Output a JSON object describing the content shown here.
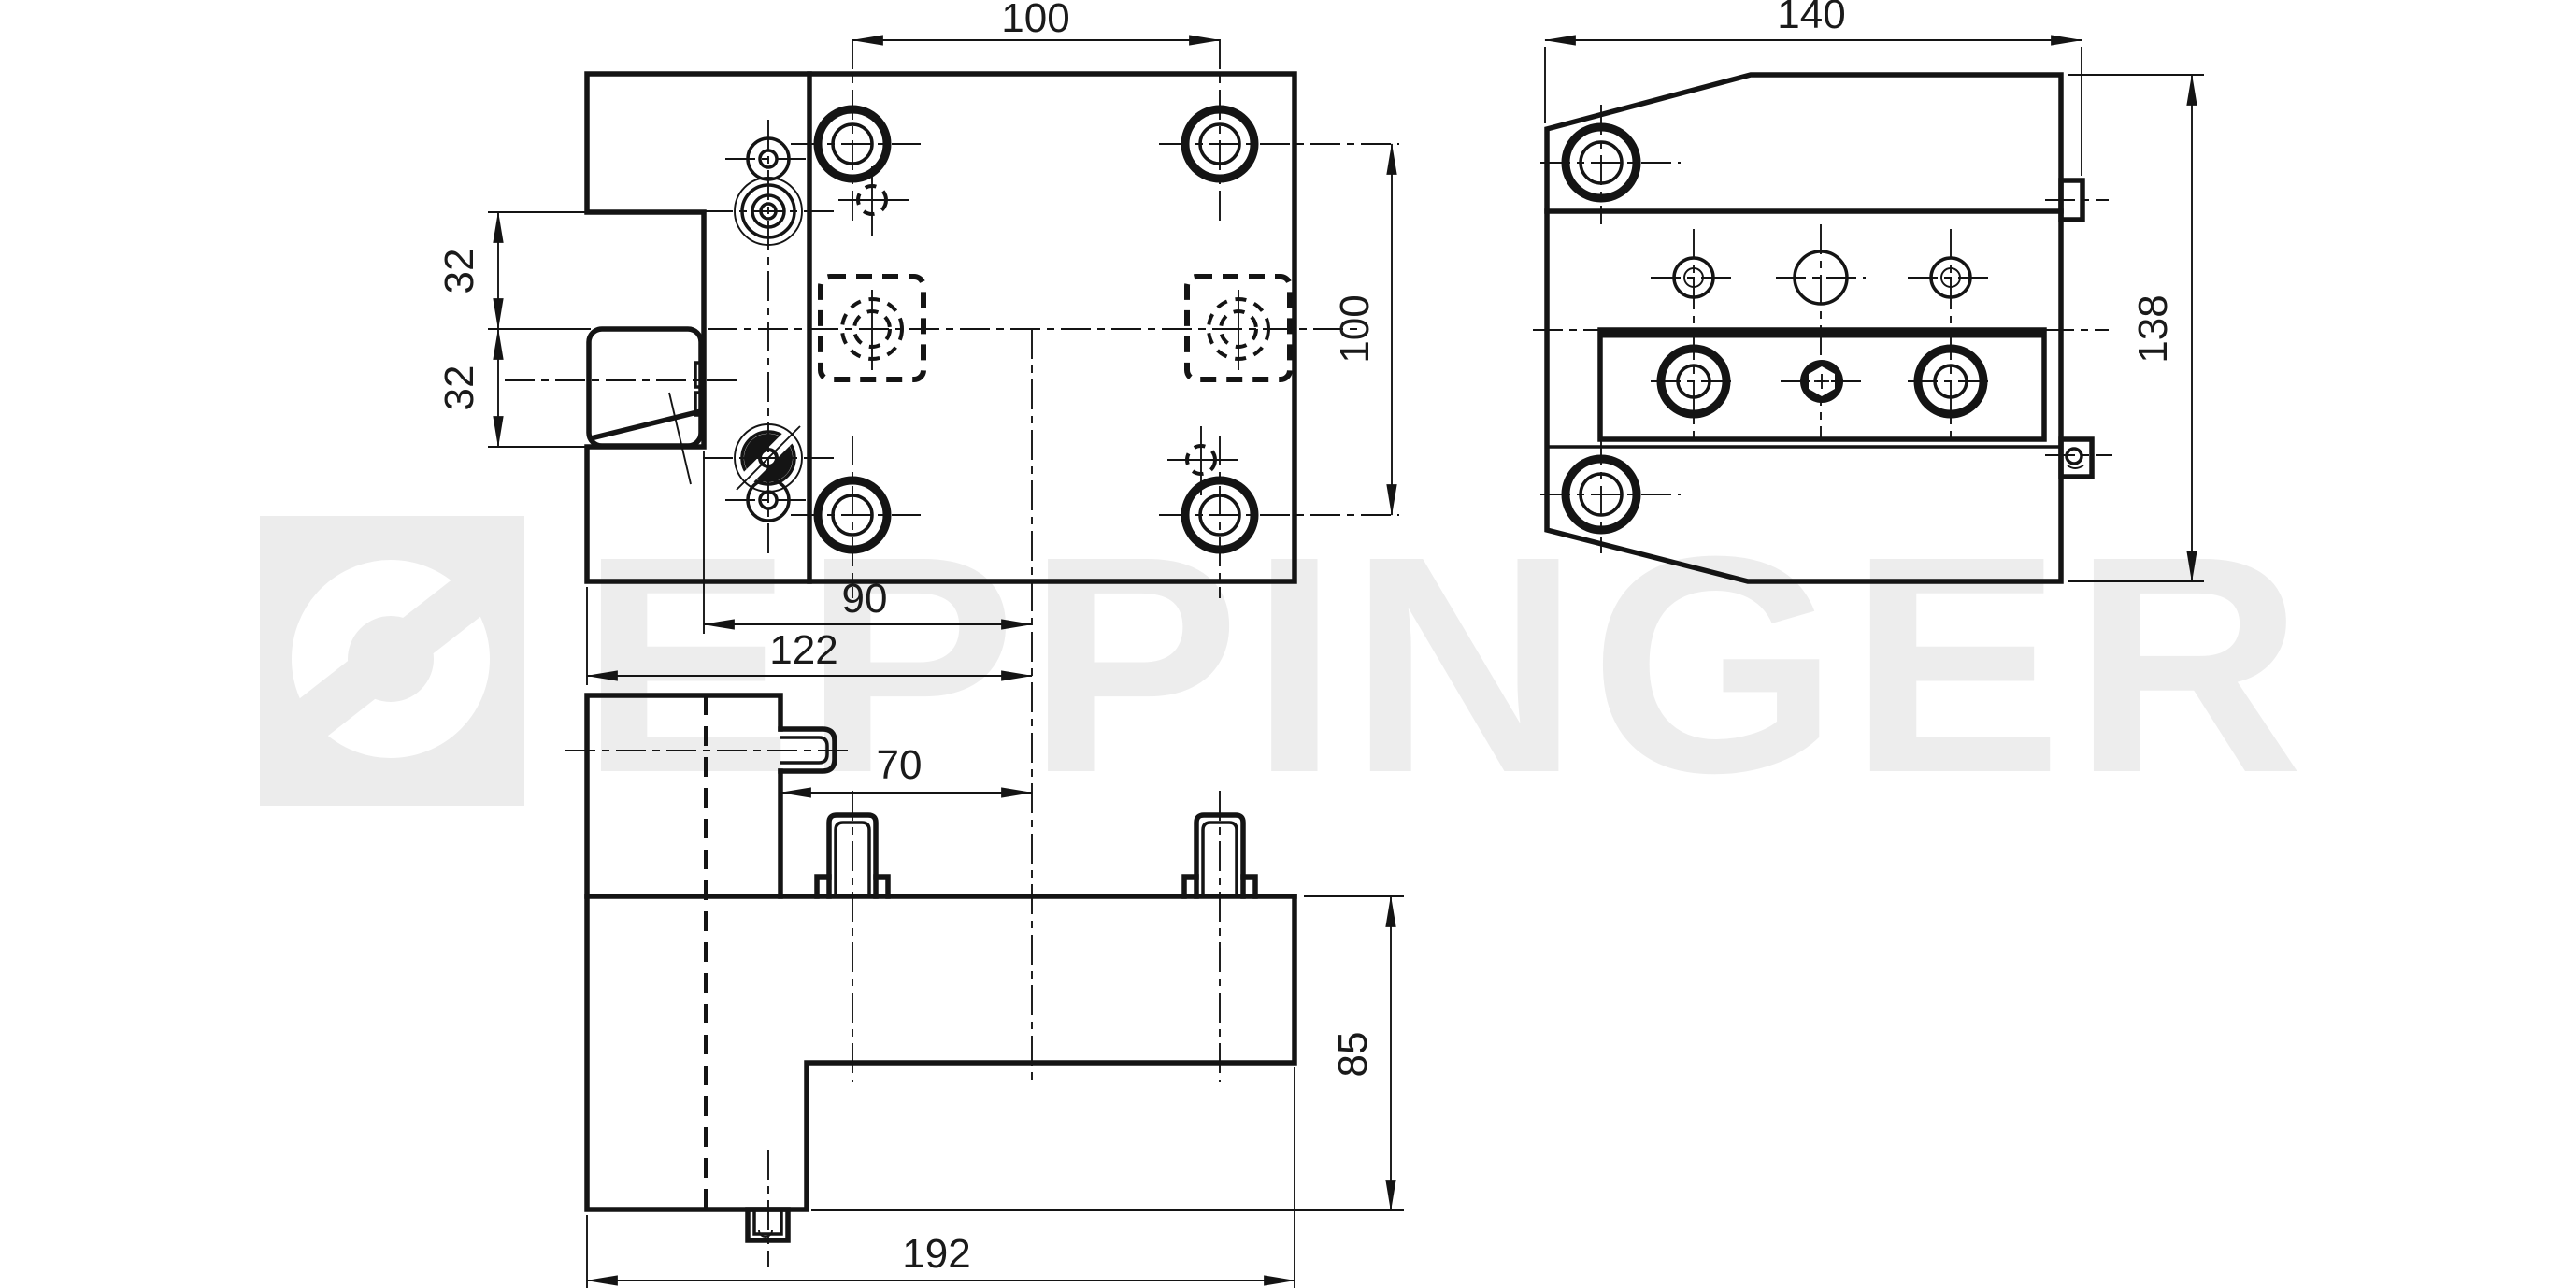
{
  "watermark": {
    "brand": "EPPINGER",
    "text_color": "#ededed",
    "logo_bg_color": "#ececec"
  },
  "drawing": {
    "background": "#ffffff",
    "line_color": "#141414",
    "dims": {
      "top_hole_spacing_x": "100",
      "top_hole_spacing_y": "100",
      "notch_upper_32": "32",
      "notch_lower_32": "32",
      "clamp_to_center_90": "90",
      "edge_to_center_122": "122",
      "block_to_center_70": "70",
      "body_height_85": "85",
      "total_width_192": "192",
      "side_width_140": "140",
      "side_height_138": "138"
    }
  }
}
